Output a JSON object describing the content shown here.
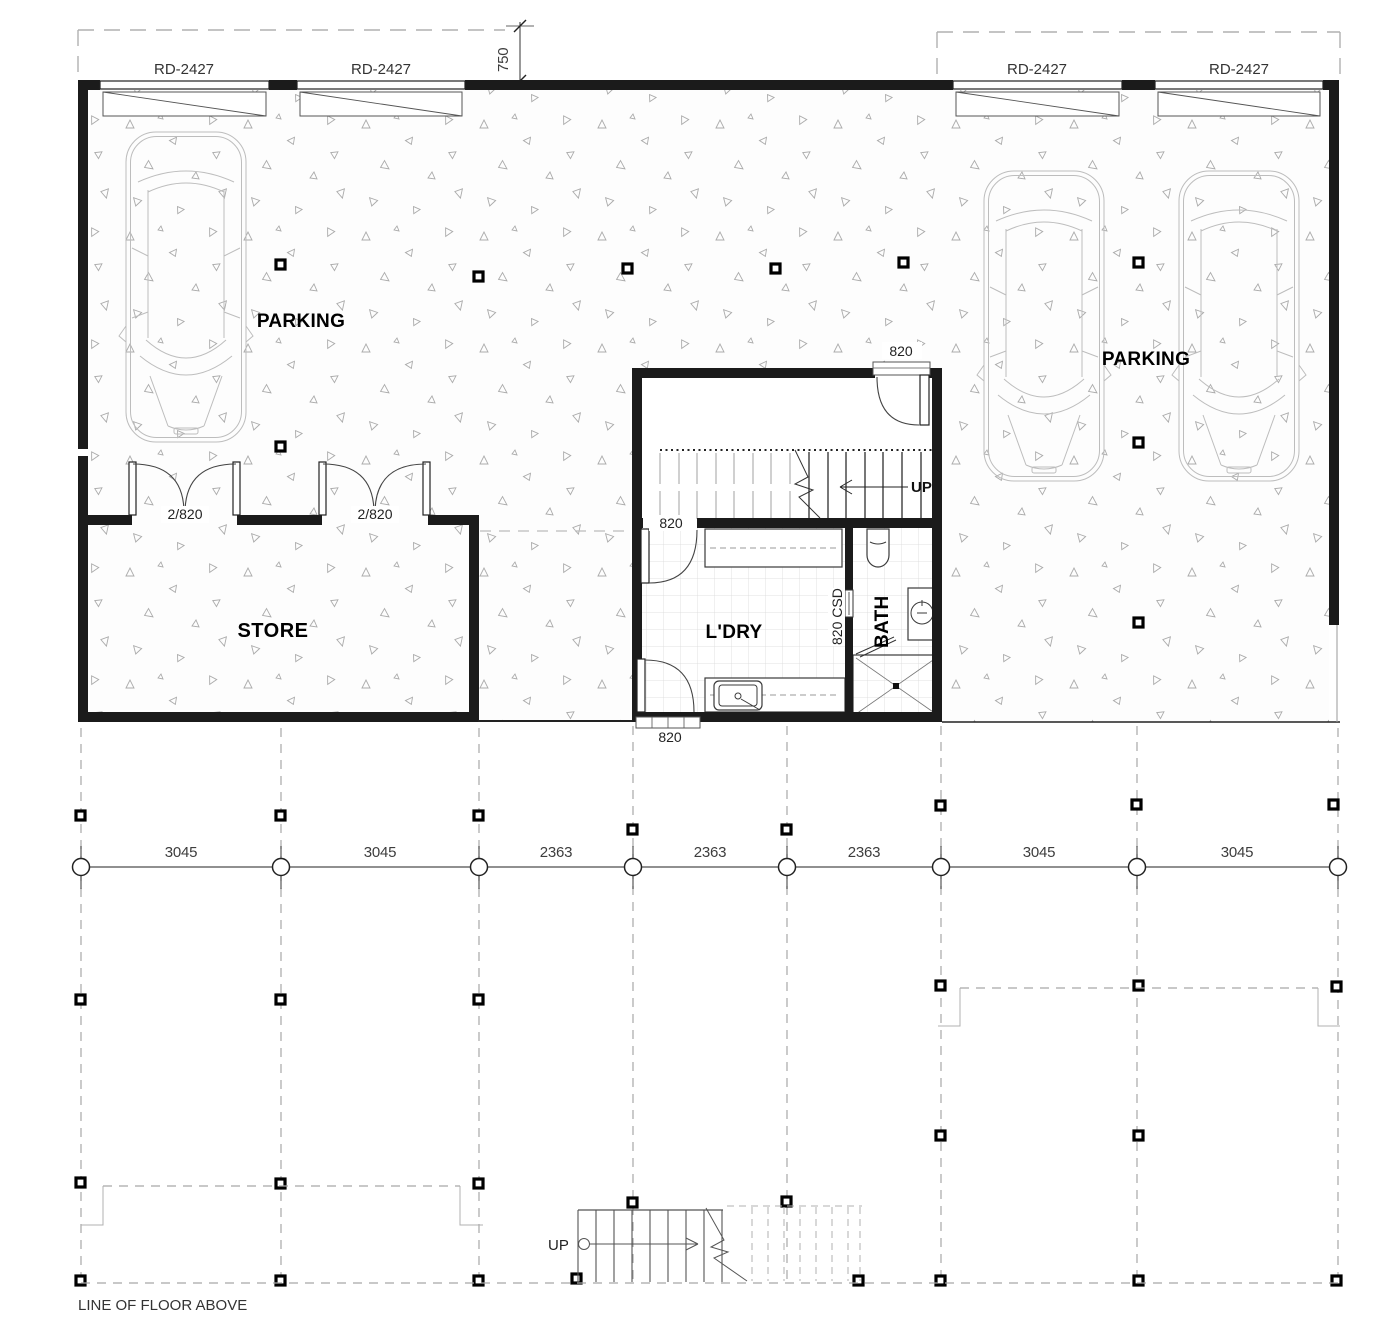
{
  "plan": {
    "rooms": {
      "parking_left": "PARKING",
      "parking_right": "PARKING",
      "store": "STORE",
      "laundry": "L'DRY",
      "bath": "BATH"
    },
    "stairs": {
      "up_main": "UP",
      "up_lower": "UP"
    },
    "doors": {
      "rd1": "RD-2427",
      "rd2": "RD-2427",
      "rd3": "RD-2427",
      "rd4": "RD-2427",
      "store1": "2/820",
      "store2": "2/820",
      "entry": "820",
      "ldry_top": "820",
      "ldry_bottom": "820",
      "csd": "820 CSD"
    },
    "dims": {
      "offset": "750",
      "grid": [
        "3045",
        "3045",
        "2363",
        "2363",
        "2363",
        "3045",
        "3045"
      ]
    },
    "notes": {
      "floor_above": "LINE OF FLOOR ABOVE"
    }
  }
}
